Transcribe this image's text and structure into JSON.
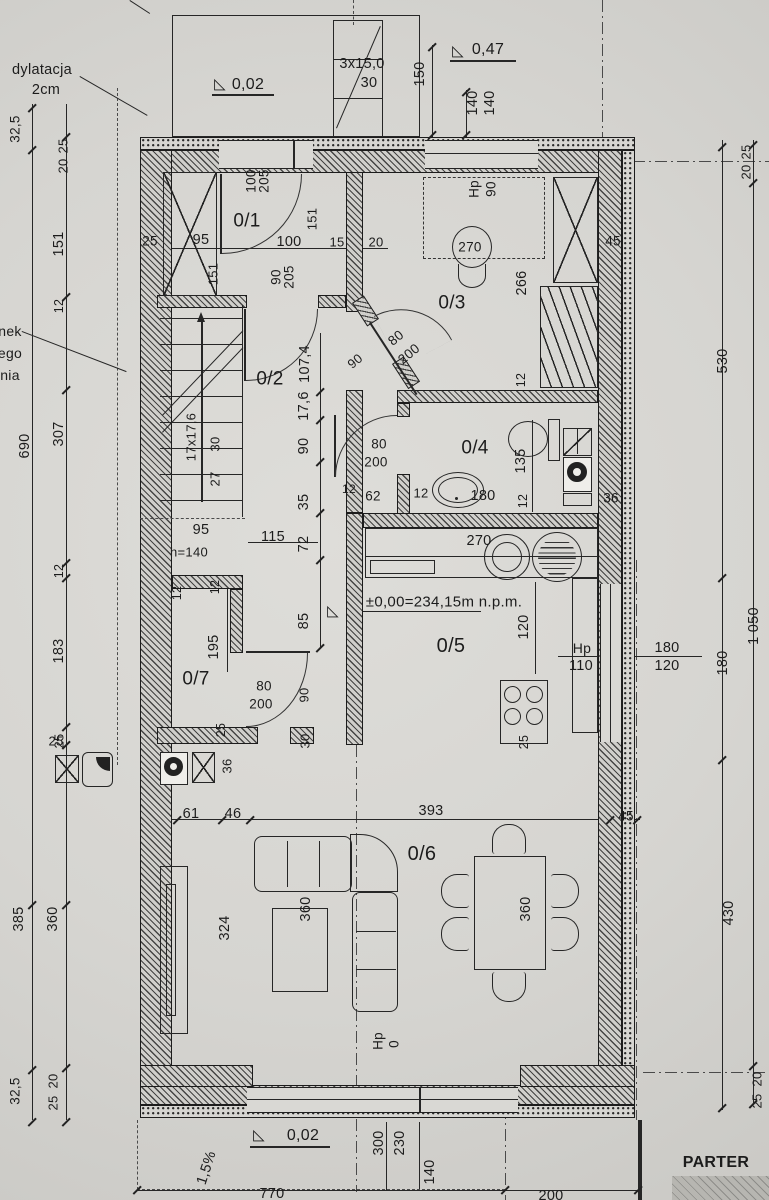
{
  "meta": {
    "floor_name": "PARTER",
    "drawing_type": "architectural floor plan, ground floor",
    "rooms": [
      "0/1",
      "0/2",
      "0/3",
      "0/4",
      "0/5",
      "0/6",
      "0/7"
    ],
    "level_marks": [
      "0,02",
      "0,47",
      "±0,00=234,15m n.p.m.",
      "0,02"
    ],
    "notes": [
      "dylatacja 2cm",
      "1,5%",
      "h=140",
      "3x15,0 / 30",
      "17x17,6 / 27 30"
    ]
  },
  "labels": [
    {
      "n": "note-dylatacja-1",
      "t": "dylatacja",
      "x": 42,
      "y": 70
    },
    {
      "n": "note-dylatacja-2",
      "t": "2cm",
      "x": 46,
      "y": 90
    },
    {
      "n": "level-porch-tri",
      "t": "◺",
      "x": 220,
      "y": 84,
      "s": 15
    },
    {
      "n": "level-porch",
      "t": "0,02",
      "x": 248,
      "y": 85,
      "s": 16
    },
    {
      "n": "ext-stairs-note-1",
      "t": "3x15,0",
      "x": 362,
      "y": 64
    },
    {
      "n": "ext-stairs-note-2",
      "t": "30",
      "x": 369,
      "y": 83
    },
    {
      "n": "level-entry-tri",
      "t": "◺",
      "x": 458,
      "y": 51,
      "s": 15
    },
    {
      "n": "level-entry",
      "t": "0,47",
      "x": 488,
      "y": 50,
      "s": 16
    },
    {
      "n": "dim-150",
      "t": "150",
      "x": 420,
      "y": 74,
      "r": -90
    },
    {
      "n": "dim-140-a",
      "t": "140",
      "x": 473,
      "y": 103,
      "r": -90
    },
    {
      "n": "dim-140-b",
      "t": "140",
      "x": 490,
      "y": 103,
      "r": -90
    },
    {
      "n": "win-hp",
      "t": "Hp",
      "x": 474,
      "y": 189,
      "r": -90,
      "s": 13.5
    },
    {
      "n": "win-hp-90",
      "t": "90",
      "x": 491,
      "y": 189,
      "r": -90,
      "s": 13.5
    },
    {
      "n": "dim-45-tr",
      "t": "45",
      "x": 613,
      "y": 241,
      "s": 13.5
    },
    {
      "n": "dim-25-r",
      "t": "25",
      "x": 746,
      "y": 152,
      "r": -90,
      "s": 13
    },
    {
      "n": "dim-20-r",
      "t": "20",
      "x": 746,
      "y": 172,
      "r": -90,
      "s": 13
    },
    {
      "n": "room-label-0-1",
      "t": "0/1",
      "x": 247,
      "y": 221,
      "s": 19
    },
    {
      "n": "door-0-1-w",
      "t": "100",
      "x": 251,
      "y": 181,
      "r": -90,
      "s": 13.5
    },
    {
      "n": "door-0-1-h",
      "t": "205",
      "x": 264,
      "y": 181,
      "r": -90,
      "s": 13.5
    },
    {
      "n": "dim-25-01",
      "t": "25",
      "x": 150,
      "y": 241,
      "s": 13.5
    },
    {
      "n": "dim-95-01",
      "t": "95",
      "x": 201,
      "y": 240
    },
    {
      "n": "dim-151-01",
      "t": "151",
      "x": 213,
      "y": 274,
      "r": -90,
      "s": 13
    },
    {
      "n": "dim-100-01",
      "t": "100",
      "x": 289,
      "y": 242
    },
    {
      "n": "dim-15-01",
      "t": "15",
      "x": 337,
      "y": 242,
      "s": 13
    },
    {
      "n": "dim-20-01",
      "t": "20",
      "x": 376,
      "y": 242,
      "s": 13
    },
    {
      "n": "dim-151-01b",
      "t": "151",
      "x": 312,
      "y": 219,
      "r": -90,
      "s": 13
    },
    {
      "n": "door-0-2-w",
      "t": "90",
      "x": 276,
      "y": 277,
      "r": -90,
      "s": 13.5
    },
    {
      "n": "door-0-2-h",
      "t": "205",
      "x": 289,
      "y": 277,
      "r": -90,
      "s": 13.5
    },
    {
      "n": "room-label-0-3",
      "t": "0/3",
      "x": 452,
      "y": 303,
      "s": 19
    },
    {
      "n": "chair-270",
      "t": "270",
      "x": 470,
      "y": 247,
      "s": 13.5
    },
    {
      "n": "dim-266",
      "t": "266",
      "x": 522,
      "y": 283,
      "r": -90
    },
    {
      "n": "dim-12-03",
      "t": "12",
      "x": 521,
      "y": 380,
      "r": -90,
      "s": 12.5
    },
    {
      "n": "door-0-3-w",
      "t": "80",
      "x": 396,
      "y": 338,
      "r": -40,
      "s": 13.5
    },
    {
      "n": "door-0-3-h",
      "t": "200",
      "x": 409,
      "y": 354,
      "r": -40,
      "s": 13.5
    },
    {
      "n": "door-0-3-90",
      "t": "90",
      "x": 355,
      "y": 361,
      "r": -40,
      "s": 13
    },
    {
      "n": "room-label-0-2",
      "t": "0/2",
      "x": 270,
      "y": 379,
      "s": 19
    },
    {
      "n": "dim-107-4",
      "t": "107,4",
      "x": 305,
      "y": 364,
      "r": -90
    },
    {
      "n": "dim-17-6",
      "t": "17,6",
      "x": 304,
      "y": 406,
      "r": -90
    },
    {
      "n": "dim-90-c",
      "t": "90",
      "x": 304,
      "y": 446,
      "r": -90
    },
    {
      "n": "dim-35-c",
      "t": "35",
      "x": 304,
      "y": 502,
      "r": -90
    },
    {
      "n": "dim-72-c",
      "t": "72",
      "x": 304,
      "y": 544,
      "r": -90
    },
    {
      "n": "dim-85-c",
      "t": "85",
      "x": 304,
      "y": 621,
      "r": -90
    },
    {
      "n": "dim-115",
      "t": "115",
      "x": 273,
      "y": 537
    },
    {
      "n": "stairs-note",
      "t": "17x17,6",
      "x": 191,
      "y": 437,
      "r": -90,
      "s": 13
    },
    {
      "n": "stairs-30",
      "t": "30",
      "x": 215,
      "y": 444,
      "r": -90,
      "s": 13
    },
    {
      "n": "stairs-27",
      "t": "27",
      "x": 215,
      "y": 479,
      "r": -90,
      "s": 13
    },
    {
      "n": "dim-95-st",
      "t": "95",
      "x": 201,
      "y": 530
    },
    {
      "n": "note-h140",
      "t": "h=140",
      "x": 189,
      "y": 552,
      "s": 13
    },
    {
      "n": "dim-12-st",
      "t": "12",
      "x": 177,
      "y": 593,
      "r": -90,
      "s": 12.5
    },
    {
      "n": "room-label-0-4",
      "t": "0/4",
      "x": 475,
      "y": 448,
      "s": 19
    },
    {
      "n": "dim-135",
      "t": "135",
      "x": 521,
      "y": 461,
      "r": -90
    },
    {
      "n": "door-0-4-w",
      "t": "80",
      "x": 379,
      "y": 444,
      "s": 13.5
    },
    {
      "n": "door-0-4-h",
      "t": "200",
      "x": 376,
      "y": 462,
      "s": 13.5
    },
    {
      "n": "dim-62",
      "t": "62",
      "x": 373,
      "y": 496,
      "s": 13.5
    },
    {
      "n": "dim-12-c1",
      "t": "12",
      "x": 349,
      "y": 489,
      "s": 12
    },
    {
      "n": "dim-12-c2",
      "t": "12",
      "x": 421,
      "y": 493,
      "s": 13
    },
    {
      "n": "dim-180-wb",
      "t": "180",
      "x": 483,
      "y": 496
    },
    {
      "n": "dim-12-c3",
      "t": "12",
      "x": 523,
      "y": 501,
      "r": -90,
      "s": 12.5
    },
    {
      "n": "dim-36-wm",
      "t": "36",
      "x": 611,
      "y": 498,
      "s": 13.5
    },
    {
      "n": "dim-270-cnt",
      "t": "270",
      "x": 479,
      "y": 541
    },
    {
      "n": "level-zero-tri",
      "t": "◺",
      "x": 333,
      "y": 611,
      "s": 15
    },
    {
      "n": "level-zero",
      "t": "±0,00=234,15m n.p.m.",
      "x": 444,
      "y": 602,
      "s": 15
    },
    {
      "n": "room-label-0-5",
      "t": "0/5",
      "x": 451,
      "y": 646,
      "s": 20
    },
    {
      "n": "dim-120-k",
      "t": "120",
      "x": 524,
      "y": 627,
      "r": -90
    },
    {
      "n": "win-k-hp",
      "t": "Hp",
      "x": 582,
      "y": 648,
      "s": 14
    },
    {
      "n": "win-k-110",
      "t": "110",
      "x": 581,
      "y": 666
    },
    {
      "n": "win-k-180",
      "t": "180",
      "x": 667,
      "y": 648
    },
    {
      "n": "win-k-120",
      "t": "120",
      "x": 667,
      "y": 666
    },
    {
      "n": "dim-530",
      "t": "530",
      "x": 723,
      "y": 361,
      "r": -90
    },
    {
      "n": "dim-180-r",
      "t": "180",
      "x": 723,
      "y": 663,
      "r": -90
    },
    {
      "n": "dim-1050",
      "t": "1 050",
      "x": 754,
      "y": 626,
      "r": -90
    },
    {
      "n": "dim-430",
      "t": "430",
      "x": 729,
      "y": 913,
      "r": -90
    },
    {
      "n": "room-label-0-7",
      "t": "0/7",
      "x": 196,
      "y": 679,
      "s": 19
    },
    {
      "n": "dim-195",
      "t": "195",
      "x": 214,
      "y": 647,
      "r": -90
    },
    {
      "n": "dim-12-07",
      "t": "12",
      "x": 215,
      "y": 587,
      "r": -90,
      "s": 12.5
    },
    {
      "n": "door-0-7-w",
      "t": "80",
      "x": 264,
      "y": 686,
      "s": 13.5
    },
    {
      "n": "door-0-7-h",
      "t": "200",
      "x": 261,
      "y": 704,
      "s": 13.5
    },
    {
      "n": "dim-90-07",
      "t": "90",
      "x": 304,
      "y": 695,
      "r": -90,
      "s": 13
    },
    {
      "n": "dim-30-07",
      "t": "30",
      "x": 305,
      "y": 741,
      "r": -90,
      "s": 13
    },
    {
      "n": "dim-25-07",
      "t": "25",
      "x": 221,
      "y": 730,
      "r": -90,
      "s": 12.5
    },
    {
      "n": "dim-36-07",
      "t": "36",
      "x": 227,
      "y": 766,
      "r": -90,
      "s": 13
    },
    {
      "n": "dim-25-drain",
      "t": "25",
      "x": 56,
      "y": 741,
      "s": 13
    },
    {
      "n": "dim-61",
      "t": "61",
      "x": 191,
      "y": 814
    },
    {
      "n": "dim-46",
      "t": "46",
      "x": 233,
      "y": 814
    },
    {
      "n": "dim-393",
      "t": "393",
      "x": 431,
      "y": 811
    },
    {
      "n": "dim-45-br",
      "t": "45",
      "x": 626,
      "y": 816,
      "s": 13.5
    },
    {
      "n": "dim-25-k",
      "t": "25",
      "x": 524,
      "y": 742,
      "r": -90,
      "s": 12.5
    },
    {
      "n": "room-label-0-6",
      "t": "0/6",
      "x": 422,
      "y": 854,
      "s": 20
    },
    {
      "n": "dim-324",
      "t": "324",
      "x": 225,
      "y": 928,
      "r": -90
    },
    {
      "n": "dim-360-ct",
      "t": "360",
      "x": 306,
      "y": 909,
      "r": -90
    },
    {
      "n": "dim-360-dt",
      "t": "360",
      "x": 526,
      "y": 909,
      "r": -90
    },
    {
      "n": "dim-hp-06",
      "t": "Hp",
      "x": 378,
      "y": 1041,
      "r": -90,
      "s": 13.5
    },
    {
      "n": "dim-hp0-06",
      "t": "0",
      "x": 394,
      "y": 1044,
      "r": -90,
      "s": 13.5
    },
    {
      "n": "dim-32-5-tl",
      "t": "32,5",
      "x": 15,
      "y": 129,
      "r": -90,
      "s": 13.5
    },
    {
      "n": "dim-25-l",
      "t": "25",
      "x": 63,
      "y": 146,
      "r": -90,
      "s": 13
    },
    {
      "n": "dim-20-l",
      "t": "20",
      "x": 63,
      "y": 166,
      "r": -90,
      "s": 13
    },
    {
      "n": "dim-151-l",
      "t": "151",
      "x": 59,
      "y": 244,
      "r": -90
    },
    {
      "n": "dim-12-l1",
      "t": "12",
      "x": 59,
      "y": 306,
      "r": -90,
      "s": 12.5
    },
    {
      "n": "dim-690",
      "t": "690",
      "x": 25,
      "y": 446,
      "r": -90
    },
    {
      "n": "dim-307",
      "t": "307",
      "x": 59,
      "y": 434,
      "r": -90
    },
    {
      "n": "dim-12-l2",
      "t": "12",
      "x": 59,
      "y": 571,
      "r": -90,
      "s": 12.5
    },
    {
      "n": "dim-183",
      "t": "183",
      "x": 59,
      "y": 651,
      "r": -90
    },
    {
      "n": "dim-25-l2",
      "t": "25",
      "x": 59,
      "y": 741,
      "r": -90,
      "s": 13
    },
    {
      "n": "dim-385",
      "t": "385",
      "x": 19,
      "y": 919,
      "r": -90
    },
    {
      "n": "dim-360-l",
      "t": "360",
      "x": 53,
      "y": 919,
      "r": -90
    },
    {
      "n": "dim-32-5-bl",
      "t": "32,5",
      "x": 15,
      "y": 1091,
      "r": -90,
      "s": 13.5
    },
    {
      "n": "dim-20-bl",
      "t": "20",
      "x": 53,
      "y": 1081,
      "r": -90,
      "s": 13
    },
    {
      "n": "dim-25-bl",
      "t": "25",
      "x": 53,
      "y": 1103,
      "r": -90,
      "s": 13
    },
    {
      "n": "level-terrace-tri",
      "t": "◺",
      "x": 259,
      "y": 1135,
      "s": 15
    },
    {
      "n": "level-terrace",
      "t": "0,02",
      "x": 303,
      "y": 1136,
      "s": 16
    },
    {
      "n": "note-slope",
      "t": "1,5%",
      "x": 207,
      "y": 1168,
      "r": -72
    },
    {
      "n": "dim-300",
      "t": "300",
      "x": 379,
      "y": 1143,
      "r": -90
    },
    {
      "n": "dim-230",
      "t": "230",
      "x": 400,
      "y": 1143,
      "r": -90
    },
    {
      "n": "dim-140-b2",
      "t": "140",
      "x": 430,
      "y": 1172,
      "r": -90
    },
    {
      "n": "dim-770",
      "t": "770",
      "x": 272,
      "y": 1194
    },
    {
      "n": "dim-200",
      "t": "200",
      "x": 551,
      "y": 1196
    },
    {
      "n": "floor-title",
      "t": "PARTER",
      "x": 716,
      "y": 1163,
      "s": 16,
      "b": 1
    },
    {
      "n": "dim-20-br",
      "t": "20",
      "x": 757,
      "y": 1079,
      "r": -90,
      "s": 13
    },
    {
      "n": "dim-25-br",
      "t": "25",
      "x": 757,
      "y": 1101,
      "r": -90,
      "s": 13
    },
    {
      "n": "edge-text-1",
      "t": "nek",
      "x": 10,
      "y": 331,
      "s": 14
    },
    {
      "n": "edge-text-2",
      "t": "ego",
      "x": 10,
      "y": 353,
      "s": 14
    },
    {
      "n": "edge-text-3",
      "t": "nia",
      "x": 10,
      "y": 375,
      "s": 14
    }
  ]
}
